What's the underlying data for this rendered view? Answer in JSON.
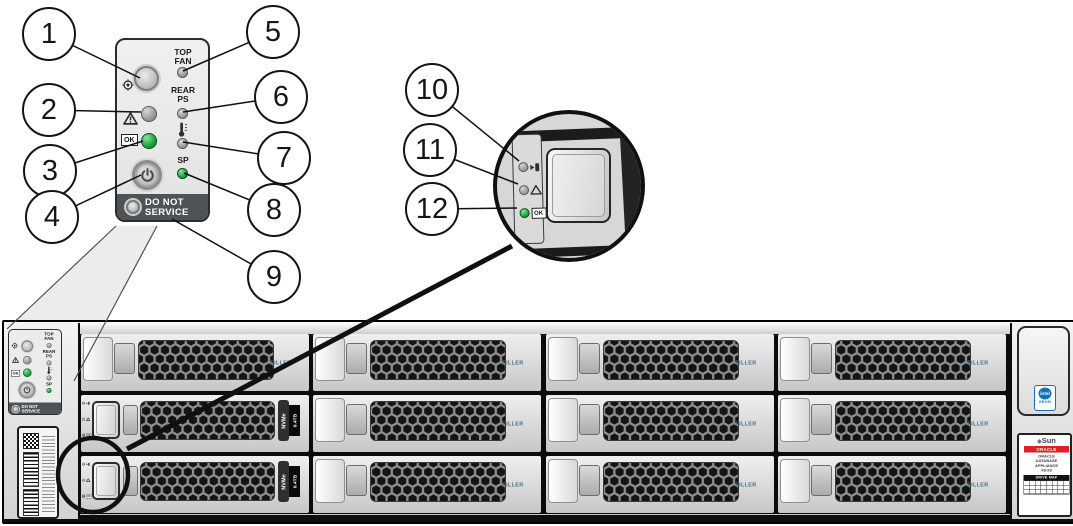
{
  "callouts": [
    "1",
    "2",
    "3",
    "4",
    "5",
    "6",
    "7",
    "8",
    "9",
    "10",
    "11",
    "12"
  ],
  "front_panel": {
    "top_fan_line1": "TOP",
    "top_fan_line2": "FAN",
    "rear_ps_line1": "REAR",
    "rear_ps_line2": "PS",
    "sp_label": "SP",
    "ok_label": "OK",
    "do_not_service_line1": "DO NOT",
    "do_not_service_line2": "SERVICE"
  },
  "drive": {
    "filler_label": "FILLER",
    "nvme_label": "NVMe",
    "capacity_label": "6.4TB",
    "ok_label": "OK"
  },
  "right_ear": {
    "intel_label": "intel",
    "xeon_label": "XEON",
    "sun_mark": "◆",
    "sun_label": "Sun",
    "oracle_label": "ORACLE",
    "product_line1": "ORACLE",
    "product_line2": "DATABASE",
    "product_line3": "APPLIANCE",
    "product_line4": "X8-2S",
    "drive_map_label": "DRIVE MAP"
  },
  "icons": {
    "locator": "bullseye-target",
    "fault": "warning-triangle",
    "ok": "ok-box",
    "power": "power-symbol",
    "temperature": "thermometer",
    "ready_to_remove": "arrow-into-box",
    "sp": "service-processor-led"
  },
  "colors": {
    "ok_green": "#18a23c",
    "led_grey": "#9a9a9a",
    "do_not_service_bg": "#4d5356",
    "oracle_red": "#e21f26",
    "intel_blue": "#1273b9",
    "filler_text": "#41708c"
  }
}
